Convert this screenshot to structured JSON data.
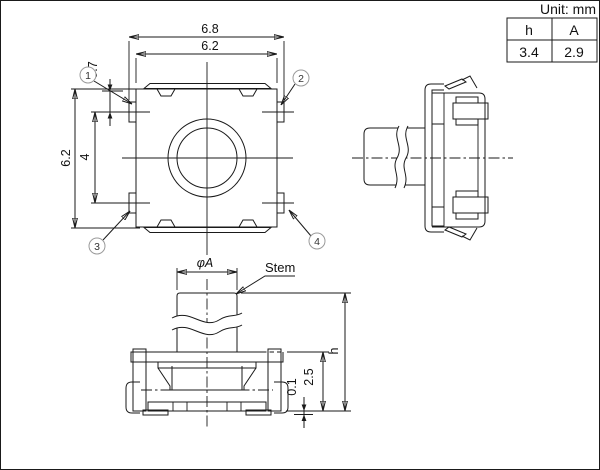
{
  "title": {
    "unit_label": "Unit: mm",
    "col_h": "h",
    "col_a": "A",
    "val_h": "3.4",
    "val_a": "2.9"
  },
  "top_view": {
    "dim_outer_width": "6.8",
    "dim_body_width": "6.2",
    "dim_body_height": "6.2",
    "dim_terminal_pitch": "4",
    "dim_terminal_offset": "0.7",
    "callouts": [
      {
        "num": "1"
      },
      {
        "num": "2"
      },
      {
        "num": "3"
      },
      {
        "num": "4"
      }
    ]
  },
  "front_view": {
    "dim_stem_diameter": "φA",
    "stem_label": "Stem",
    "dim_total_height": "h",
    "dim_base_height": "2.5",
    "dim_standoff": "0.1"
  },
  "colors": {
    "line": "#1a1a1a",
    "callout_circle": "#9a9a9a",
    "background": "#ffffff"
  }
}
